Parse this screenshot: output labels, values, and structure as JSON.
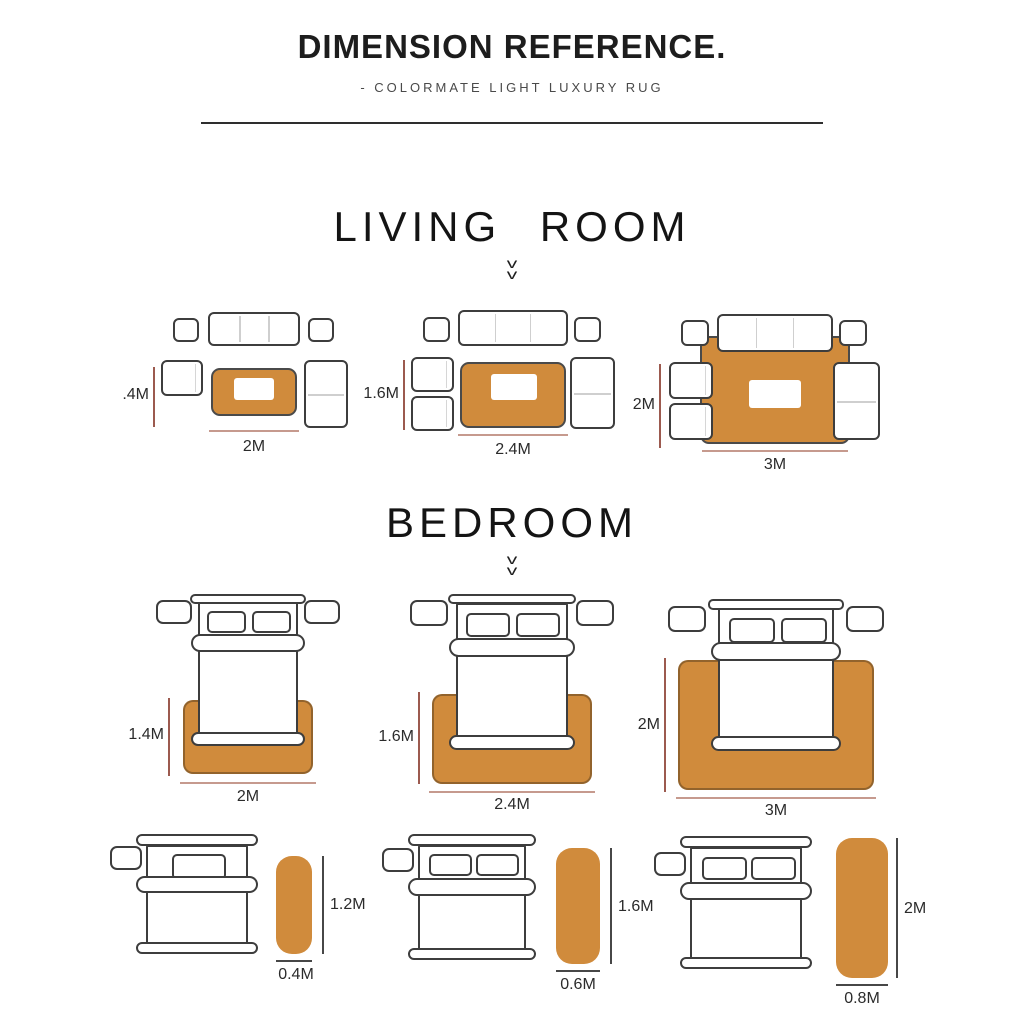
{
  "header": {
    "title": "DIMENSION REFERENCE.",
    "subtitle": "- COLORMATE LIGHT LUXURY RUG"
  },
  "living_room": {
    "heading": "LIVING ROOM",
    "chevron": "v",
    "layouts": [
      {
        "height_label": ".4M",
        "width_label": "2M"
      },
      {
        "height_label": "1.6M",
        "width_label": "2.4M"
      },
      {
        "height_label": "2M",
        "width_label": "3M"
      }
    ]
  },
  "bedroom": {
    "heading": "BEDROOM",
    "chevron": "v",
    "bed_layouts": [
      {
        "height_label": "1.4M",
        "width_label": "2M"
      },
      {
        "height_label": "1.6M",
        "width_label": "2.4M"
      },
      {
        "height_label": "2M",
        "width_label": "3M"
      }
    ],
    "runner_layouts": [
      {
        "height_label": "1.2M",
        "width_label": "0.4M"
      },
      {
        "height_label": "1.6M",
        "width_label": "0.6M"
      },
      {
        "height_label": "2M",
        "width_label": "0.8M"
      }
    ]
  },
  "colors": {
    "rug": "#d08b3c",
    "dimension_line_red": "#9c5a4f",
    "dimension_line_light": "#c69a8e",
    "dimension_line_dark": "#474747",
    "furniture_outline": "#3d3d3d"
  }
}
